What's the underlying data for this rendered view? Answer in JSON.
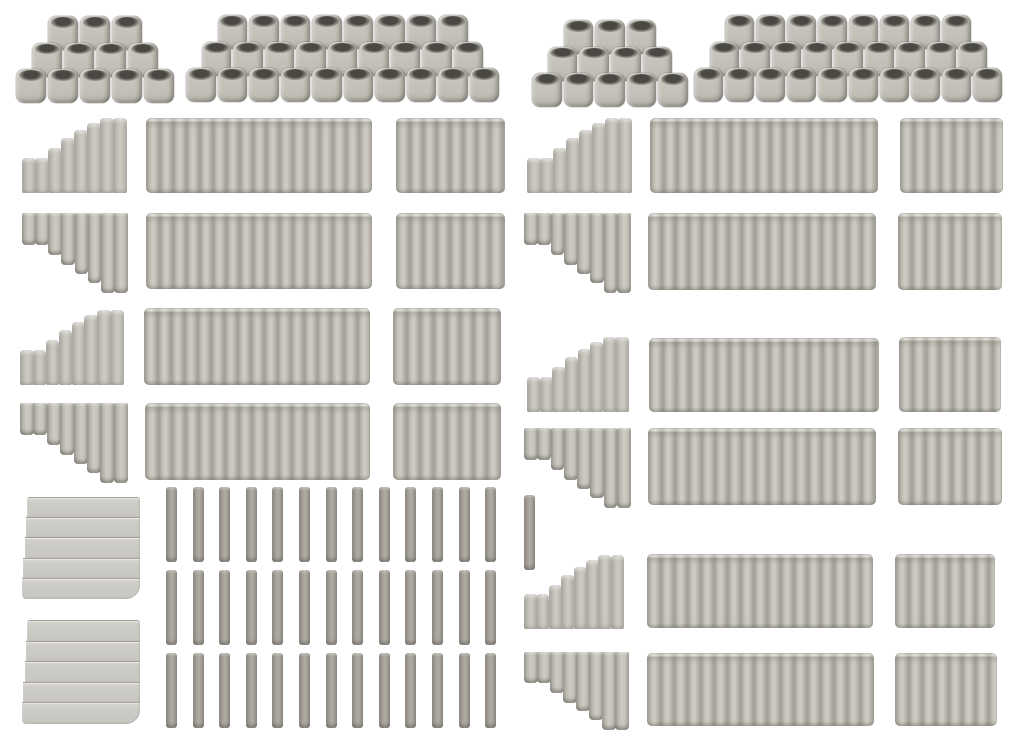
{
  "meta": {
    "description": "White-background product photo of grey model-kit parts: corrugated pile walls, stepped slope end walls, pyramids of stacked open cylinders, loose single piles and smooth stepped blocks",
    "background": "#ffffff",
    "canvas": {
      "width": 1024,
      "height": 748
    }
  },
  "palette": {
    "background": "#ffffff",
    "piece_base": "#c5c2ba",
    "piece_highlight": "#cecbc3",
    "piece_groove": "#a5a29a",
    "piece_shadow": "#8d8981",
    "opening_dark": "#383631",
    "strip_base": "#a4a098",
    "smooth_base": "#cdcbc6",
    "smooth_line": "#a4a19b"
  },
  "scene": {
    "pyramids": [
      {
        "name": "pile-pyramid-small-left",
        "x": 16,
        "y": 16,
        "cyl_w": 32,
        "cyl_h": 34,
        "v_step": 26.5,
        "rows": [
          3,
          4,
          5
        ]
      },
      {
        "name": "pile-pyramid-large-left",
        "x": 186,
        "y": 15,
        "cyl_w": 31.5,
        "cyl_h": 34,
        "v_step": 26.5,
        "rows": [
          8,
          9,
          10
        ]
      },
      {
        "name": "pile-pyramid-small-right",
        "x": 532,
        "y": 20,
        "cyl_w": 31.6,
        "cyl_h": 34,
        "v_step": 26.5,
        "rows": [
          3,
          4,
          5
        ]
      },
      {
        "name": "pile-pyramid-large-right",
        "x": 694,
        "y": 15,
        "cyl_w": 31,
        "cyl_h": 34,
        "v_step": 26.5,
        "rows": [
          8,
          9,
          10
        ]
      }
    ],
    "step_profiles": {
      "up": [
        35,
        35,
        45,
        55,
        63,
        70,
        75,
        75
      ],
      "up_ref": 75,
      "down": [
        32,
        32,
        42,
        52,
        61,
        70,
        80,
        80
      ],
      "down_ref": 80
    },
    "walls": [
      {
        "type": "step-up",
        "x": 22,
        "y": 118,
        "w": 104,
        "h": 75
      },
      {
        "type": "long",
        "x": 146,
        "y": 118,
        "w": 226,
        "h": 75
      },
      {
        "type": "short",
        "x": 396,
        "y": 118,
        "w": 109,
        "h": 75
      },
      {
        "type": "step-down",
        "x": 22,
        "y": 213,
        "w": 105,
        "h": 80
      },
      {
        "type": "long",
        "x": 146,
        "y": 213,
        "w": 226,
        "h": 76
      },
      {
        "type": "short",
        "x": 396,
        "y": 213,
        "w": 109,
        "h": 76
      },
      {
        "type": "step-up",
        "x": 20,
        "y": 310,
        "w": 103,
        "h": 75
      },
      {
        "type": "long",
        "x": 144,
        "y": 308,
        "w": 226,
        "h": 77
      },
      {
        "type": "short",
        "x": 393,
        "y": 308,
        "w": 108,
        "h": 77
      },
      {
        "type": "step-down",
        "x": 20,
        "y": 403,
        "w": 107,
        "h": 80
      },
      {
        "type": "long",
        "x": 145,
        "y": 403,
        "w": 225,
        "h": 77
      },
      {
        "type": "short",
        "x": 393,
        "y": 403,
        "w": 108,
        "h": 77
      },
      {
        "type": "step-up",
        "x": 527,
        "y": 118,
        "w": 104,
        "h": 75
      },
      {
        "type": "long",
        "x": 650,
        "y": 118,
        "w": 228,
        "h": 75
      },
      {
        "type": "short",
        "x": 900,
        "y": 118,
        "w": 103,
        "h": 75
      },
      {
        "type": "step-down",
        "x": 524,
        "y": 213,
        "w": 106,
        "h": 80
      },
      {
        "type": "long",
        "x": 648,
        "y": 213,
        "w": 228,
        "h": 77
      },
      {
        "type": "short",
        "x": 898,
        "y": 213,
        "w": 104,
        "h": 77
      },
      {
        "type": "step-up",
        "x": 527,
        "y": 337,
        "w": 101,
        "h": 75
      },
      {
        "type": "long",
        "x": 649,
        "y": 338,
        "w": 230,
        "h": 74
      },
      {
        "type": "short",
        "x": 899,
        "y": 337,
        "w": 102,
        "h": 75
      },
      {
        "type": "step-down",
        "x": 524,
        "y": 428,
        "w": 106,
        "h": 80
      },
      {
        "type": "long",
        "x": 648,
        "y": 428,
        "w": 228,
        "h": 77
      },
      {
        "type": "short",
        "x": 898,
        "y": 428,
        "w": 104,
        "h": 77
      },
      {
        "type": "step-up",
        "x": 524,
        "y": 555,
        "w": 99,
        "h": 74
      },
      {
        "type": "long",
        "x": 647,
        "y": 554,
        "w": 226,
        "h": 74
      },
      {
        "type": "short",
        "x": 895,
        "y": 554,
        "w": 100,
        "h": 74
      },
      {
        "type": "step-down",
        "x": 524,
        "y": 652,
        "w": 104,
        "h": 78
      },
      {
        "type": "long",
        "x": 647,
        "y": 653,
        "w": 227,
        "h": 73
      },
      {
        "type": "short",
        "x": 895,
        "y": 653,
        "w": 102,
        "h": 73
      }
    ],
    "strip_grid": {
      "x_start": 166,
      "pitch": 26.6,
      "strip_w": 11,
      "strip_h": 75,
      "rows": [
        {
          "y": 487,
          "count": 13
        },
        {
          "y": 570,
          "count": 13
        },
        {
          "y": 653,
          "count": 13
        }
      ]
    },
    "lone_strip": {
      "x": 524,
      "y": 495,
      "w": 11,
      "h": 75
    },
    "smooth_stacks": [
      {
        "x": 22,
        "y": 497,
        "w": 118,
        "h": 101,
        "slats": 5
      },
      {
        "x": 22,
        "y": 620,
        "w": 118,
        "h": 103,
        "slats": 5
      }
    ]
  }
}
